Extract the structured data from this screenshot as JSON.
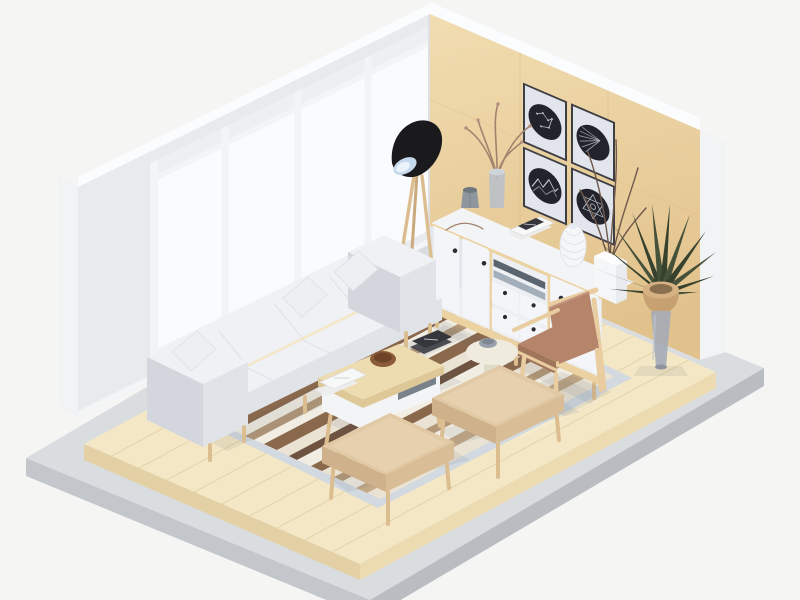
{
  "meta": {
    "type": "3d-isometric-room-render",
    "subject": "living room diorama"
  },
  "scene": {
    "description": "Isometric 3D render of a Scandinavian living room: white window wall, light wood feature wall with four framed circular artworks, white sideboard with wood trim and black knobs, black cone floor lamp on wood tripod, white four-seat sofa with throw pillows, striped area rug, wood coffee table with magazines and bowl, terracotta wood armchair, round cream side table, two beige ottomans, potted dracaena plant, pale wood plank floor on a gray concrete platform.",
    "objects": [
      {
        "name": "window-wall",
        "label": "White wall with large bright windows"
      },
      {
        "name": "wood-wall",
        "label": "Light wood feature wall"
      },
      {
        "name": "artwork-grid",
        "label": "Four framed artworks with dark circles",
        "items": [
          "constellation print",
          "radial fan print",
          "mountain zigzag print",
          "geometric star print"
        ]
      },
      {
        "name": "sideboard",
        "label": "White sideboard with two left doors, open shelf, four drawers, right door, black knobs, wood base"
      },
      {
        "name": "sideboard-decor",
        "label": "Faceted gray vase, glass vase with dried branches, twig, magazine stack, lattice vase, cuboid vase with tall twigs"
      },
      {
        "name": "floor-lamp",
        "label": "Black cone shade floor lamp on wooden tripod"
      },
      {
        "name": "potted-plant",
        "label": "Dracaena plant in wood-top cone vase"
      },
      {
        "name": "area-rug",
        "label": "Cream shag rug with brown and tan stripes and blue-gray border"
      },
      {
        "name": "sofa",
        "label": "White four-seat sofa with three pillows and wood legs"
      },
      {
        "name": "coffee-table",
        "label": "Wood-top coffee table with white base, books, bowl, magazines"
      },
      {
        "name": "armchair",
        "label": "Wood frame armchair with terracotta cushions"
      },
      {
        "name": "side-table",
        "label": "Round cream pedestal side table with gray bowl"
      },
      {
        "name": "ottoman-front",
        "label": "Beige ottoman bench"
      },
      {
        "name": "ottoman-back",
        "label": "Beige ottoman bench"
      },
      {
        "name": "wood-floor",
        "label": "Pale wood plank floor slab"
      },
      {
        "name": "platform",
        "label": "Gray concrete display platform"
      }
    ]
  },
  "colors": {
    "bg": "#f5f5f4",
    "platform_top": "#dadde0",
    "platform_side": "#c3c7cb",
    "platform_side_dark": "#b9bdc1",
    "floor_wood": "#f3e7c5",
    "floor_side_left": "#e3d0a5",
    "floor_side_right": "#ecdab1",
    "plank_line": "#e2cfa2",
    "left_wall": "#e8eaed",
    "wall_rim": "#fbfcfd",
    "wall_end": "#f2f3f5",
    "glass": "#fafbfc",
    "glass_upper": "#edf0f3",
    "mullion": "#f3f4f6",
    "wood_wall_light": "#f1ddb1",
    "wood_wall_dark": "#e2c28c",
    "wood_seam": "#d9bd89",
    "pic_frame": "#3e3f44",
    "pic_mat": "#e2e6ec",
    "pic_circle": "#23242b",
    "pic_art": "#c2c7d1",
    "sideboard_top": "#f2f4f6",
    "sideboard_front": "#edeff2",
    "sideboard_side": "#e3e6ea",
    "panel": "#f3f5f8",
    "trim_wood": "#ecd2a0",
    "knob": "#2d2d30",
    "slot_dark": "#5a6570",
    "slot_shelf": "#a2aeba",
    "lamp_black": "#1a1a1c",
    "lamp_inner": "#c5d8ec",
    "leg_wood": "#dcbd90",
    "leg_wood_dark": "#caa97c",
    "plant_green": "#46513a",
    "plant_green_dark": "#37422e",
    "pot_wood": "#d6b183",
    "pot_wood_dark": "#c8a172",
    "pot_cone": "#a6abb6",
    "rug_border": "#d2d9e0",
    "rug_cream": "#eae3d4",
    "rug_white": "#f1ede3",
    "rug_tan": "#c4aa86",
    "rug_taupe": "#b39878",
    "rug_brown": "#8a684b",
    "rug_dark": "#6e5340",
    "sofa_body": "#eff1f4",
    "sofa_shade": "#e0e3e8",
    "sofa_dark": "#d3d7dd",
    "pillow": "#edeff3",
    "table_wood": "#eddcb0",
    "table_wood_edge": "#dfc897",
    "table_white": "#f2f4f6",
    "bowl_brown": "#8a5c39",
    "bowl_brown_dark": "#6d4427",
    "book_dark": "#34363b",
    "paper": "#f7f8f8",
    "chair_wood": "#e9cda0",
    "chair_cushion": "#b5846a",
    "chair_cushion_dark": "#a0755c",
    "ottoman_top": "#e2c9a5",
    "ottoman_side": "#cfb28b",
    "ottoman_front": "#d8bd96",
    "side_table": "#f0ebdf",
    "side_table_shade": "#e0dac9",
    "bowl_gray": "#99a2ac",
    "branch": "#a3826f",
    "twig_dark": "#6e594c",
    "vase_gray": "#8f969e",
    "vase_glass": "#b9c0c8",
    "white_vase": "#f5f6f8",
    "shadow": "rgba(90,95,105,0.10)"
  }
}
